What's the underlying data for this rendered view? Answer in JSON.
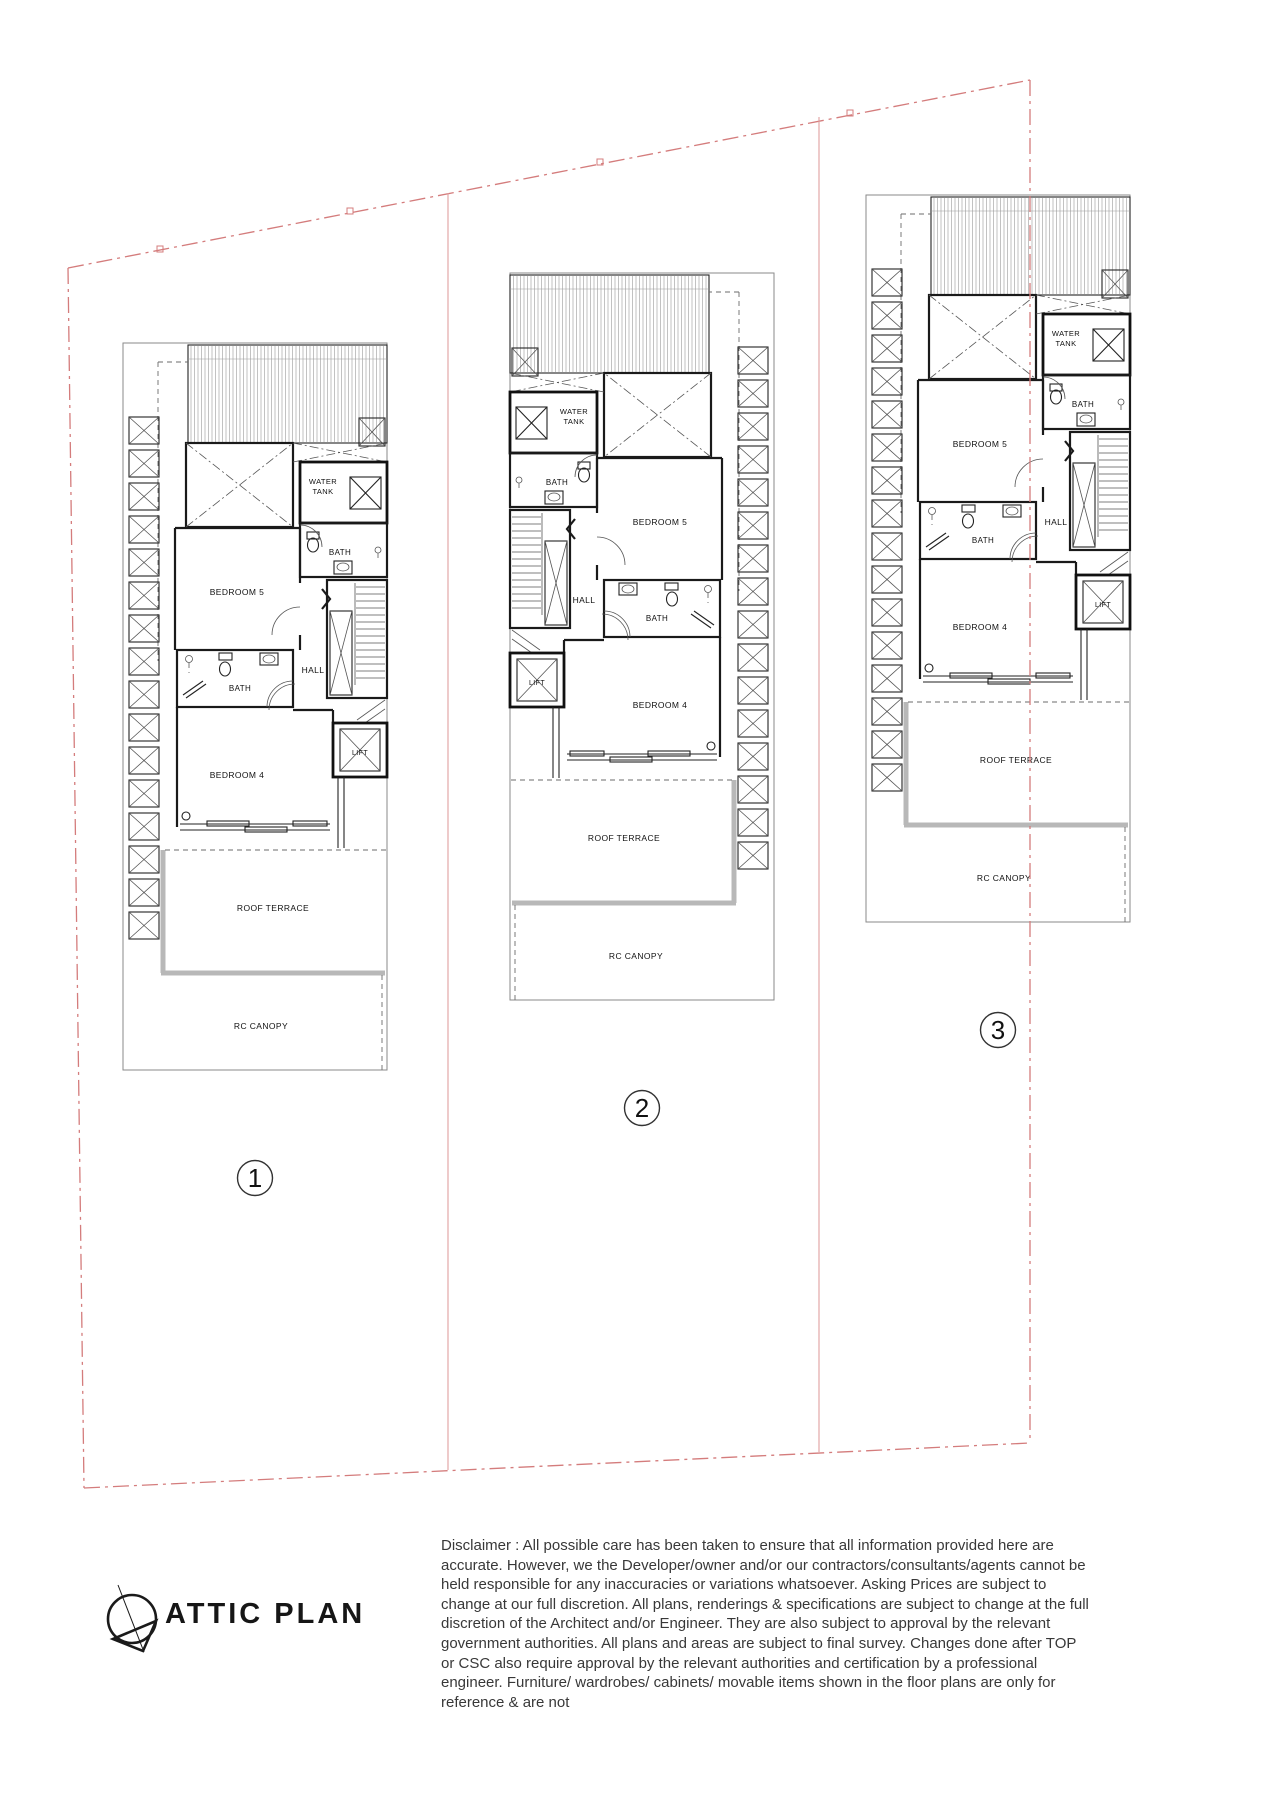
{
  "page": {
    "title_label": "ATTIC PLAN"
  },
  "plan_labels": {
    "water_tank_line1": "WATER",
    "water_tank_line2": "TANK",
    "bath": "BATH",
    "bedroom5": "BEDROOM 5",
    "hall": "HALL",
    "bedroom4": "BEDROOM 4",
    "lift": "LIFT",
    "roof_terrace": "ROOF TERRACE",
    "rc_canopy": "RC CANOPY"
  },
  "units": [
    {
      "number": "1"
    },
    {
      "number": "2"
    },
    {
      "number": "3"
    }
  ],
  "disclaimer": "Disclaimer : All possible care has been taken to ensure that all information provided here are accurate. However, we the Developer/owner and/or our contractors/consultants/agents cannot be held responsible for any inaccuracies or variations whatsoever. Asking Prices are subject to change at our full discretion. All plans, renderings & specifications are subject to change at the full discretion of the Architect and/or Engineer. They are also subject to approval by the relevant government authorities. All plans and areas are subject to final survey. Changes done after TOP or CSC also require approval by the relevant authorities and certification by a professional engineer. Furniture/ wardrobes/ cabinets/ movable items shown in the floor plans are only for reference & are not",
  "colors": {
    "boundary_red": "#d47c7c",
    "wall_black": "#1a1a1a",
    "terrace_gray": "#b8b8b8"
  }
}
